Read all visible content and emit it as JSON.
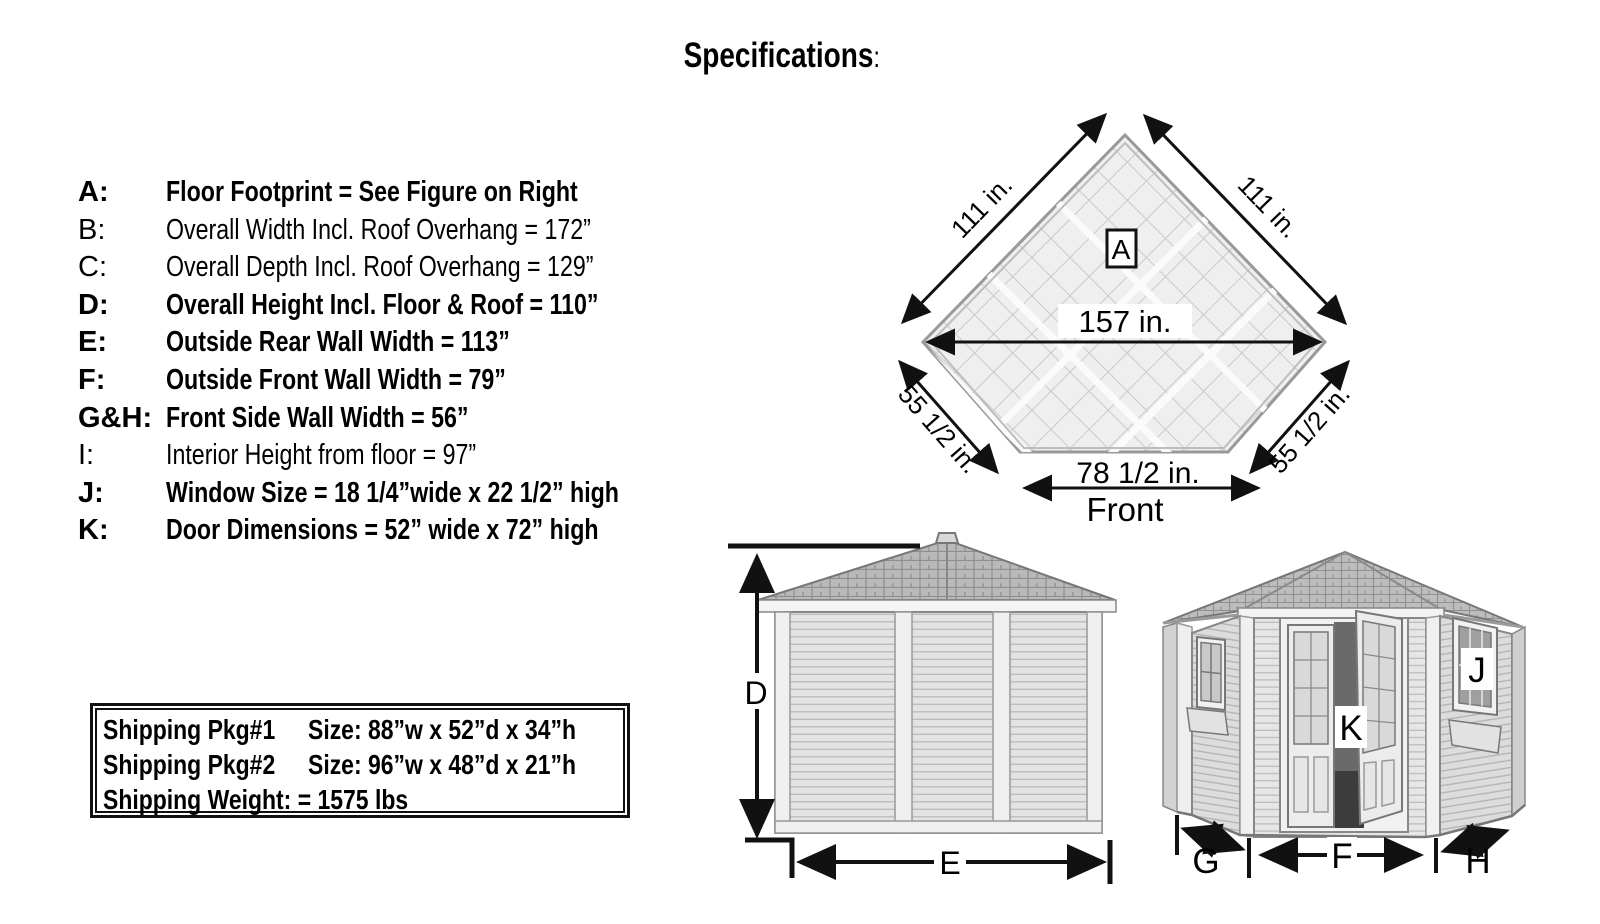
{
  "title": {
    "text": "Specifications",
    "colon": ":"
  },
  "spec_list": {
    "items": [
      {
        "key": "A:",
        "desc": "Floor Footprint = See Figure on Right"
      },
      {
        "key": "B:",
        "desc": "Overall Width Incl. Roof Overhang = 172”"
      },
      {
        "key": "C:",
        "desc": "Overall Depth Incl. Roof Overhang = 129”"
      },
      {
        "key": "D:",
        "desc": "Overall Height Incl. Floor & Roof = 110”"
      },
      {
        "key": "E:",
        "desc": "Outside Rear Wall Width = 113”"
      },
      {
        "key": "F:",
        "desc": "Outside Front Wall Width = 79”"
      },
      {
        "key": "G&H:",
        "desc": "Front Side Wall Width = 56”"
      },
      {
        "key": "I:",
        "desc": "Interior Height from floor = 97”"
      },
      {
        "key": "J:",
        "desc": "Window Size = 18 1/4”wide x 22 1/2” high"
      },
      {
        "key": "K:",
        "desc": "Door Dimensions = 52” wide x 72” high"
      }
    ]
  },
  "shipping_box": {
    "rows": [
      {
        "name": "Shipping Pkg#1",
        "value": "Size:  88”w x 52”d x 34”h"
      },
      {
        "name": "Shipping Pkg#2",
        "value": "Size:  96”w x 48”d x 21”h"
      }
    ],
    "weight": "Shipping Weight: = 1575 lbs"
  },
  "floor_plan": {
    "label_a": "A",
    "dim_upper_left": "111 in.",
    "dim_upper_right": "111 in.",
    "dim_width": "157 in.",
    "dim_lower_left": "55 1/2 in.",
    "dim_lower_right": "55 1/2 in.",
    "dim_front_wall": "78 1/2 in.",
    "front_label": "Front"
  },
  "rear_elevation": {
    "dim_height": "D",
    "dim_width": "E"
  },
  "front_view": {
    "dim_left_wall": "G",
    "dim_front_wall": "F",
    "dim_right_wall": "H",
    "window_label": "J",
    "door_label": "K"
  },
  "colors": {
    "line": "#111111",
    "roof": "#b9b9b9",
    "wall": "#e3e3e3",
    "trim": "#f1f1f1",
    "floor": "#efefef"
  }
}
